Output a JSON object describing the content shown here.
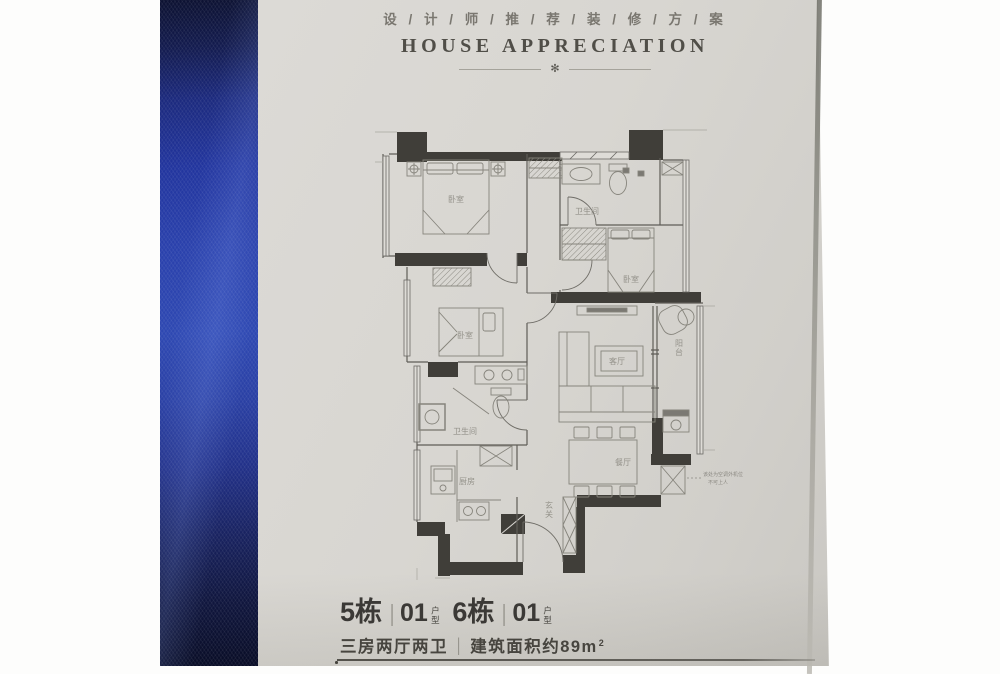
{
  "header": {
    "title_cn": "设 / 计 / 师 / 推 / 荐 / 装 / 修 / 方 / 案",
    "title_en": "HOUSE APPRECIATION",
    "ornament_icon": "✻"
  },
  "floor_plan": {
    "rooms": {
      "bedroom_top_left": "卧室",
      "bathroom_top": "卫生间",
      "bedroom_right": "卧室",
      "bedroom_middle": "卧室",
      "bathroom_lower": "卫生间",
      "kitchen": "厨房",
      "living_room": "客厅",
      "dining_room": "餐厅",
      "balcony": "阳台",
      "entry": "玄关"
    },
    "note": {
      "line1": "该处为空调外机位",
      "line2": "不可上人"
    }
  },
  "footer": {
    "block1": {
      "building": "5栋",
      "divider": "|",
      "unit": "01",
      "unit_suffix": "户型"
    },
    "block2": {
      "building": "6栋",
      "divider": "|",
      "unit": "01",
      "unit_suffix": "户型"
    },
    "layout": "三房两厅两卫",
    "divider": "|",
    "area": "建筑面积约89m",
    "area_sup": "2"
  },
  "colors": {
    "fabric_blue": "#2a41ac",
    "paper": "#d7d5d0",
    "wall_dark": "#403e39",
    "ink": "#3b3936"
  }
}
